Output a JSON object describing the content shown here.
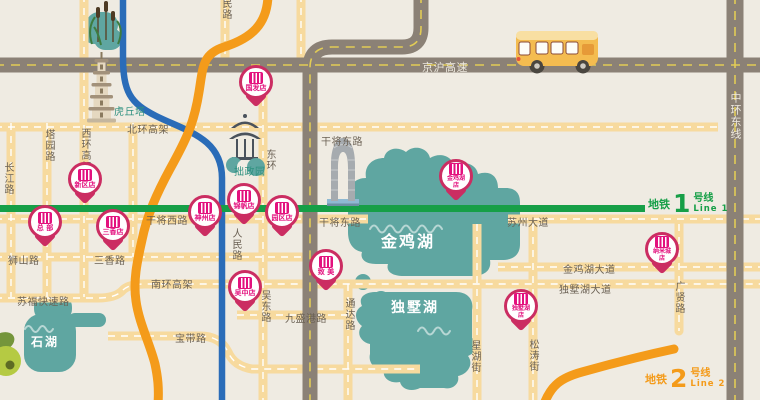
{
  "roads": {
    "jinghu_expwy": "京沪高速",
    "zhonghuan_east": "中环东线",
    "beihuan_viaduct": "北环高架",
    "ganjiang_east_upper": "干将东路",
    "ganjiang_west": "干将西路",
    "ganjiang_east": "干将东路",
    "suzhou_ave": "苏州大道",
    "jinjihu_ave": "金鸡湖大道",
    "dushuhu_ave": "独墅湖大道",
    "nanhuan_viaduct": "南环高架",
    "sufu_expwy": "苏福快速路",
    "shishan_rd": "狮山路",
    "sanxiang_rd": "三香路",
    "baodai_rd": "宝带路",
    "jiushenggang_rd": "九盛港路",
    "changjiang_rd": "长江路",
    "tayuan_rd": "塔园路",
    "xihuan_viaduct": "西环高架",
    "renmin_rd_top": "民路",
    "renmin_rd": "人民路",
    "donghuan": "东环",
    "wudong_rd": "吴东路",
    "tongda_rd": "通达路",
    "xinghu_st": "星湖街",
    "songtao_st": "松涛街",
    "guangxian_rd": "广贤路"
  },
  "landmarks": {
    "huqiu_tower": "虎丘塔",
    "zhuozheng_garden": "拙政园",
    "jinji_lake": "金鸡湖",
    "dushu_lake": "独墅湖",
    "shihu_lake": "石湖"
  },
  "metro": {
    "line1": {
      "system": "地铁",
      "number": "1",
      "line_word": "号线",
      "en": "Line 1"
    },
    "line2": {
      "system": "地铁",
      "number": "2",
      "line_word": "号线",
      "en": "Line 2"
    }
  },
  "stores": [
    {
      "name": "国发店"
    },
    {
      "name": "新区店"
    },
    {
      "name": "总 部"
    },
    {
      "name": "三香店"
    },
    {
      "name": "神州店"
    },
    {
      "name": "锦帆店"
    },
    {
      "name": "园区店"
    },
    {
      "name": "吴中店"
    },
    {
      "name": "致 美"
    },
    {
      "name": "金鸡湖",
      "name2": "店"
    },
    {
      "name": "纳米城",
      "name2": "店"
    },
    {
      "name": "独墅湖",
      "name2": "店"
    }
  ],
  "colors": {
    "background": "#EFEBE2",
    "road_yellow": "#F7DA9E",
    "road_gray": "#8B8176",
    "lake_teal": "#5FA6A1",
    "metro_line1_green": "#169F47",
    "metro_line2_orange": "#F49B1A",
    "metro_blue": "#2A6CB8",
    "pin_crimson": "#CB2D62",
    "pin_logo_magenta": "#E3117E"
  }
}
